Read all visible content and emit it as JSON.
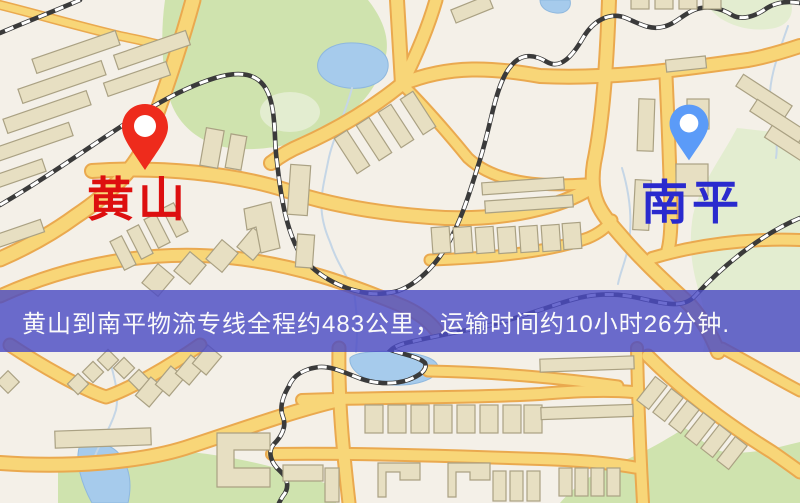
{
  "page": {
    "width": 800,
    "height": 503
  },
  "map": {
    "origin_label": "黄山",
    "destination_label": "南平",
    "banner": {
      "text": "黄山到南平物流专线全程约483公里，运输时间约10小时26分钟."
    },
    "icons": {
      "origin_pin": "red-map-pin-icon",
      "destination_pin": "blue-map-pin-icon"
    },
    "colors": {
      "land": "#f4f0e8",
      "road_fill": "#f8d678",
      "road_casing": "#eaa94f",
      "water": "#a6cbec",
      "water_edge": "#8fb8de",
      "park": "#cfe3ae",
      "park_pale": "#e3edd0",
      "building": "#e7dfc2",
      "building_edge": "#aaa183",
      "railway_dark": "#3a3a3a",
      "railway_light": "#ffffff",
      "stream": "#c5d6e6",
      "pin_origin": "#ee2b1c",
      "pin_dest": "#5b9bf8",
      "label_origin": "#dd0f0f",
      "label_dest": "#2a2ace",
      "banner_bg": "rgba(76,76,197,0.82)",
      "banner_text": "#fafafa"
    }
  }
}
